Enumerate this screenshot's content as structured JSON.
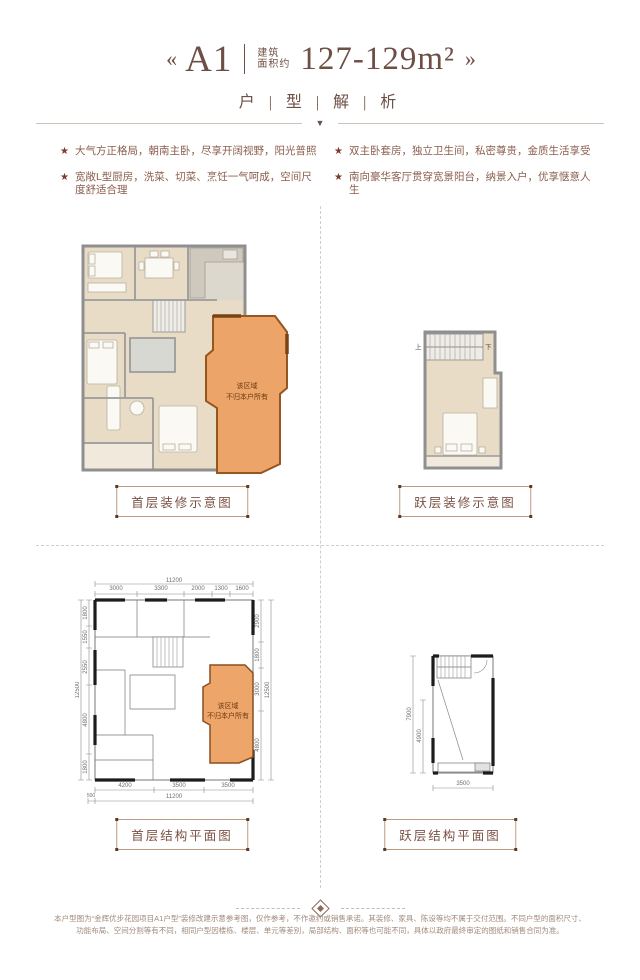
{
  "header": {
    "arrow_left": "«",
    "arrow_right": "»",
    "unit_name": "A1",
    "area_label_top": "建筑",
    "area_label_bottom": "面积约",
    "area_value": "127-129m²",
    "subtitle": "户 | 型 | 解 | 析",
    "divider_icon": "▼"
  },
  "features": {
    "bullet_icon": "★",
    "items": [
      "大气方正格局，朝南主卧，尽享开阔视野，阳光普照",
      "双主卧套房，独立卫生间，私密尊贵，金质生活享受",
      "宽敞L型厨房，洗菜、切菜、烹饪一气呵成，空间尺度舒适合理",
      "南向豪华客厅贯穿宽景阳台，纳景入户，优享惬意人生"
    ]
  },
  "plans": {
    "decor_main_label": "首层装修示意图",
    "decor_loft_label": "跃层装修示意图",
    "struct_main_label": "首层结构平面图",
    "struct_loft_label": "跃层结构平面图",
    "not_owned": {
      "line1": "该区域",
      "line2": "不归本户所有"
    },
    "loft_stair_up": "上",
    "loft_stair_down": "下",
    "struct_main": {
      "top_total": "11200",
      "top_segments": [
        "3000",
        "3300",
        "2000",
        "1300",
        "1600"
      ],
      "left_total": "12500",
      "left_segments": [
        "1800",
        "1550",
        "2550",
        "4800",
        "1800"
      ],
      "right_total": "12500",
      "right_segments": [
        "2900",
        "1800",
        "3000",
        "4800"
      ],
      "bottom_total": "11200",
      "bottom_segments": [
        "4200",
        "3500",
        "3500"
      ],
      "bottom_offset": "500"
    },
    "struct_loft": {
      "left_total": "7900",
      "left_inner": "4900",
      "bottom": "3500"
    }
  },
  "colors": {
    "title_brown": "#6e4f45",
    "feature_text": "#8a5d4c",
    "star_red": "#7d3b2a",
    "orange_fill": "#eca468",
    "orange_border": "#95561f",
    "wall_gray": "#8f8f8f",
    "wall_black": "#1c1c1c",
    "label_border": "#c09a7e"
  },
  "footer": {
    "line1": "本户型图为“金辉优步花园项目A1户型”装修改建示意参考图，仅作参考，不作邀约或销售承诺。其装修、家具、陈设等均不属于交付范围。不同户型的面积尺寸、",
    "line2": "功能布局、空间分割等有不同，相同户型因楼栋、楼层、单元等差别，局部结构、面积等也可能不同，具体以政府最终审定的图纸和销售合同为准。"
  }
}
